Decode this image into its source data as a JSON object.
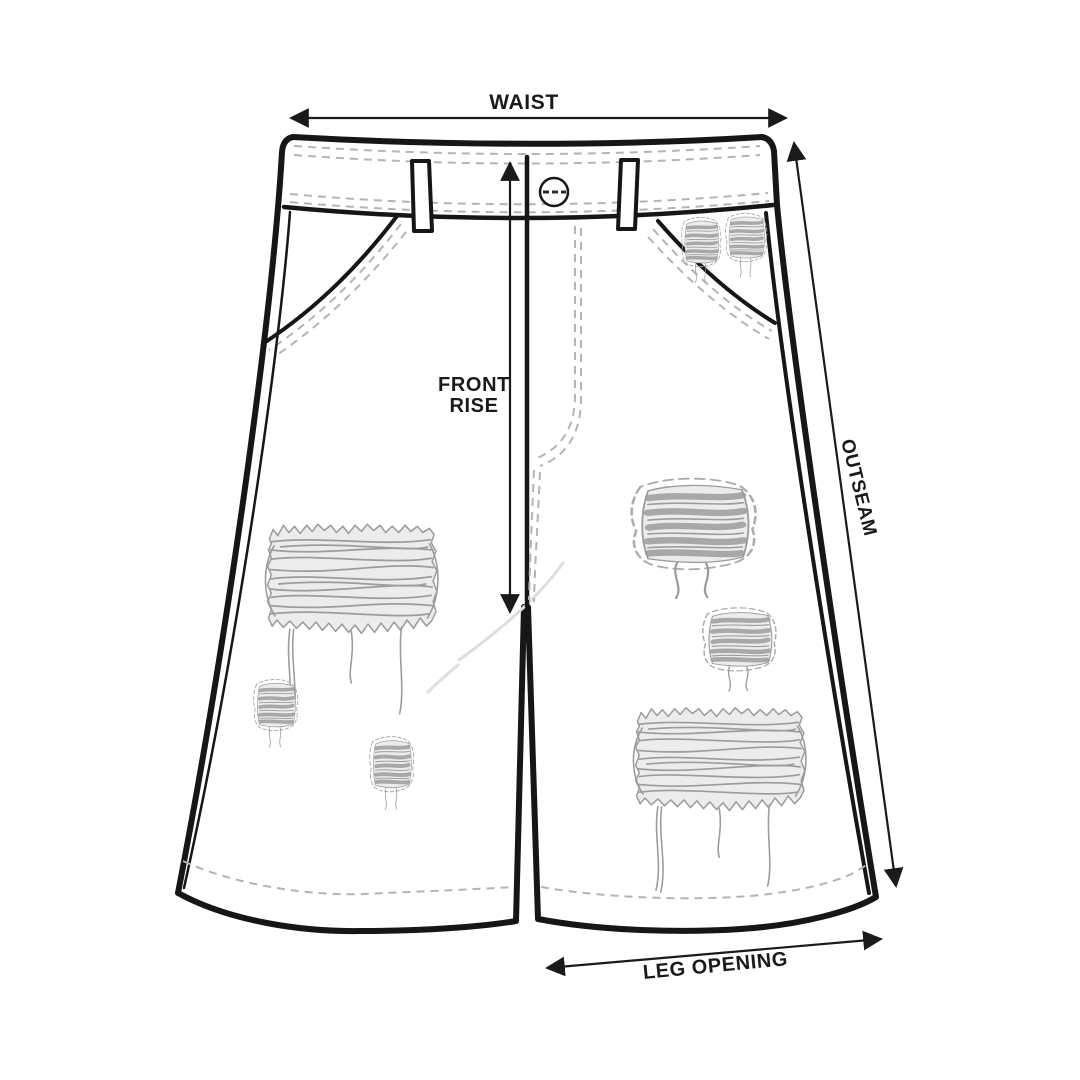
{
  "labels": {
    "waist": "WAIST",
    "front_rise_line1": "FRONT",
    "front_rise_line2": "RISE",
    "outseam": "OUTSEAM",
    "leg_opening": "LEG OPENING"
  },
  "colors": {
    "background": "#ffffff",
    "outline": "#161616",
    "label": "#1a1a1a",
    "stitch": "#b4b4b4",
    "distress": "#9c9c9c",
    "ripfill": "#ececec",
    "crease": "#dedede"
  }
}
